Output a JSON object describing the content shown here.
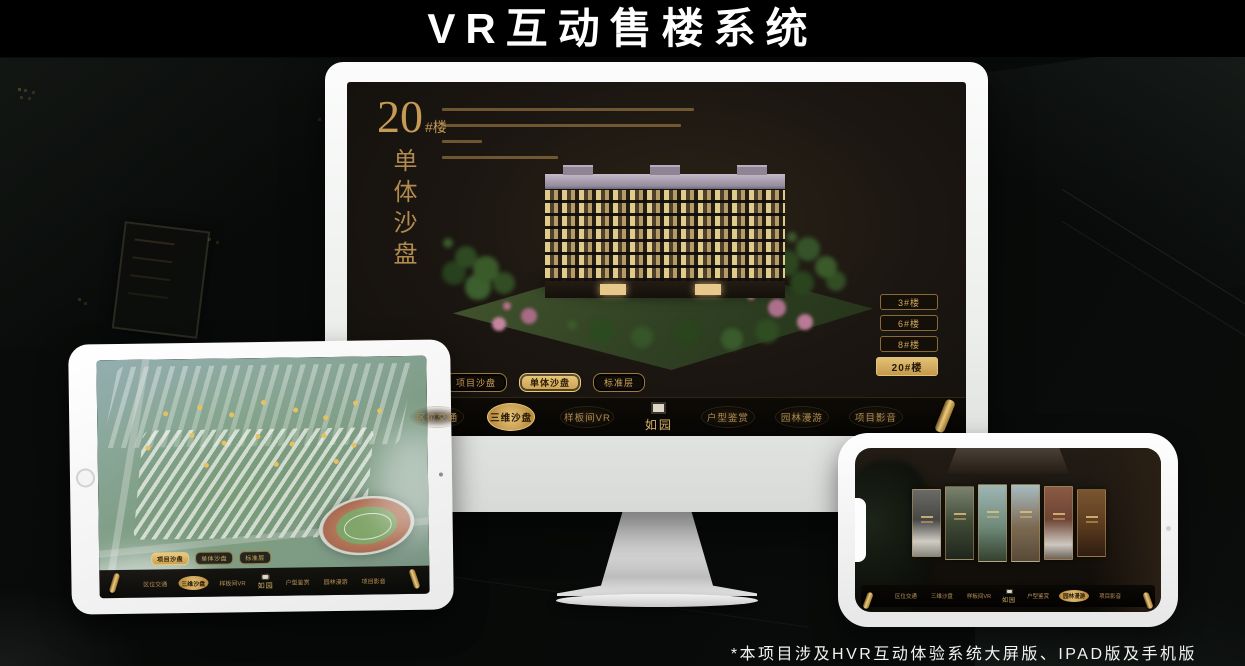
{
  "title": "VR互动售楼系统",
  "footnote": "*本项目涉及HVR互动体验系统大屏版、IPAD版及手机版",
  "colors": {
    "gold": "#c9a35c",
    "gold_bright": "#e7c479",
    "screen_bg": "#1b1611",
    "device_white": "#f2f3f2"
  },
  "desktop": {
    "headline": {
      "number": "20",
      "suffix": "#楼",
      "vertical": "单体沙盘"
    },
    "floor_buttons": [
      {
        "label": "3#楼",
        "active": false
      },
      {
        "label": "6#楼",
        "active": false
      },
      {
        "label": "8#楼",
        "active": false
      },
      {
        "label": "20#楼",
        "active": true
      }
    ],
    "view_tabs": [
      {
        "label": "项目沙盘",
        "active": false
      },
      {
        "label": "单体沙盘",
        "active": true
      },
      {
        "label": "标准层",
        "active": false
      }
    ],
    "nav": {
      "logo": "如园",
      "items": [
        {
          "label": "区位交通",
          "active": false
        },
        {
          "label": "三维沙盘",
          "active": true
        },
        {
          "label": "样板间VR",
          "active": false
        },
        {
          "label": "户型鉴赏",
          "active": false
        },
        {
          "label": "园林漫游",
          "active": false
        },
        {
          "label": "项目影音",
          "active": false
        }
      ]
    }
  },
  "tablet": {
    "view_tabs": [
      {
        "label": "项目沙盘",
        "active": true
      },
      {
        "label": "单体沙盘",
        "active": false
      },
      {
        "label": "标准层",
        "active": false
      }
    ],
    "nav": {
      "logo": "如园",
      "items": [
        {
          "label": "区位交通",
          "active": false
        },
        {
          "label": "三维沙盘",
          "active": true
        },
        {
          "label": "样板间VR",
          "active": false
        },
        {
          "label": "户型鉴赏",
          "active": false
        },
        {
          "label": "园林漫游",
          "active": false
        },
        {
          "label": "项目影音",
          "active": false
        }
      ]
    }
  },
  "phone": {
    "nav": {
      "logo": "如园",
      "items": [
        {
          "label": "区位交通",
          "active": false
        },
        {
          "label": "三维沙盘",
          "active": false
        },
        {
          "label": "样板间VR",
          "active": false
        },
        {
          "label": "户型鉴赏",
          "active": false
        },
        {
          "label": "园林漫游",
          "active": true
        },
        {
          "label": "项目影音",
          "active": false
        }
      ]
    }
  }
}
